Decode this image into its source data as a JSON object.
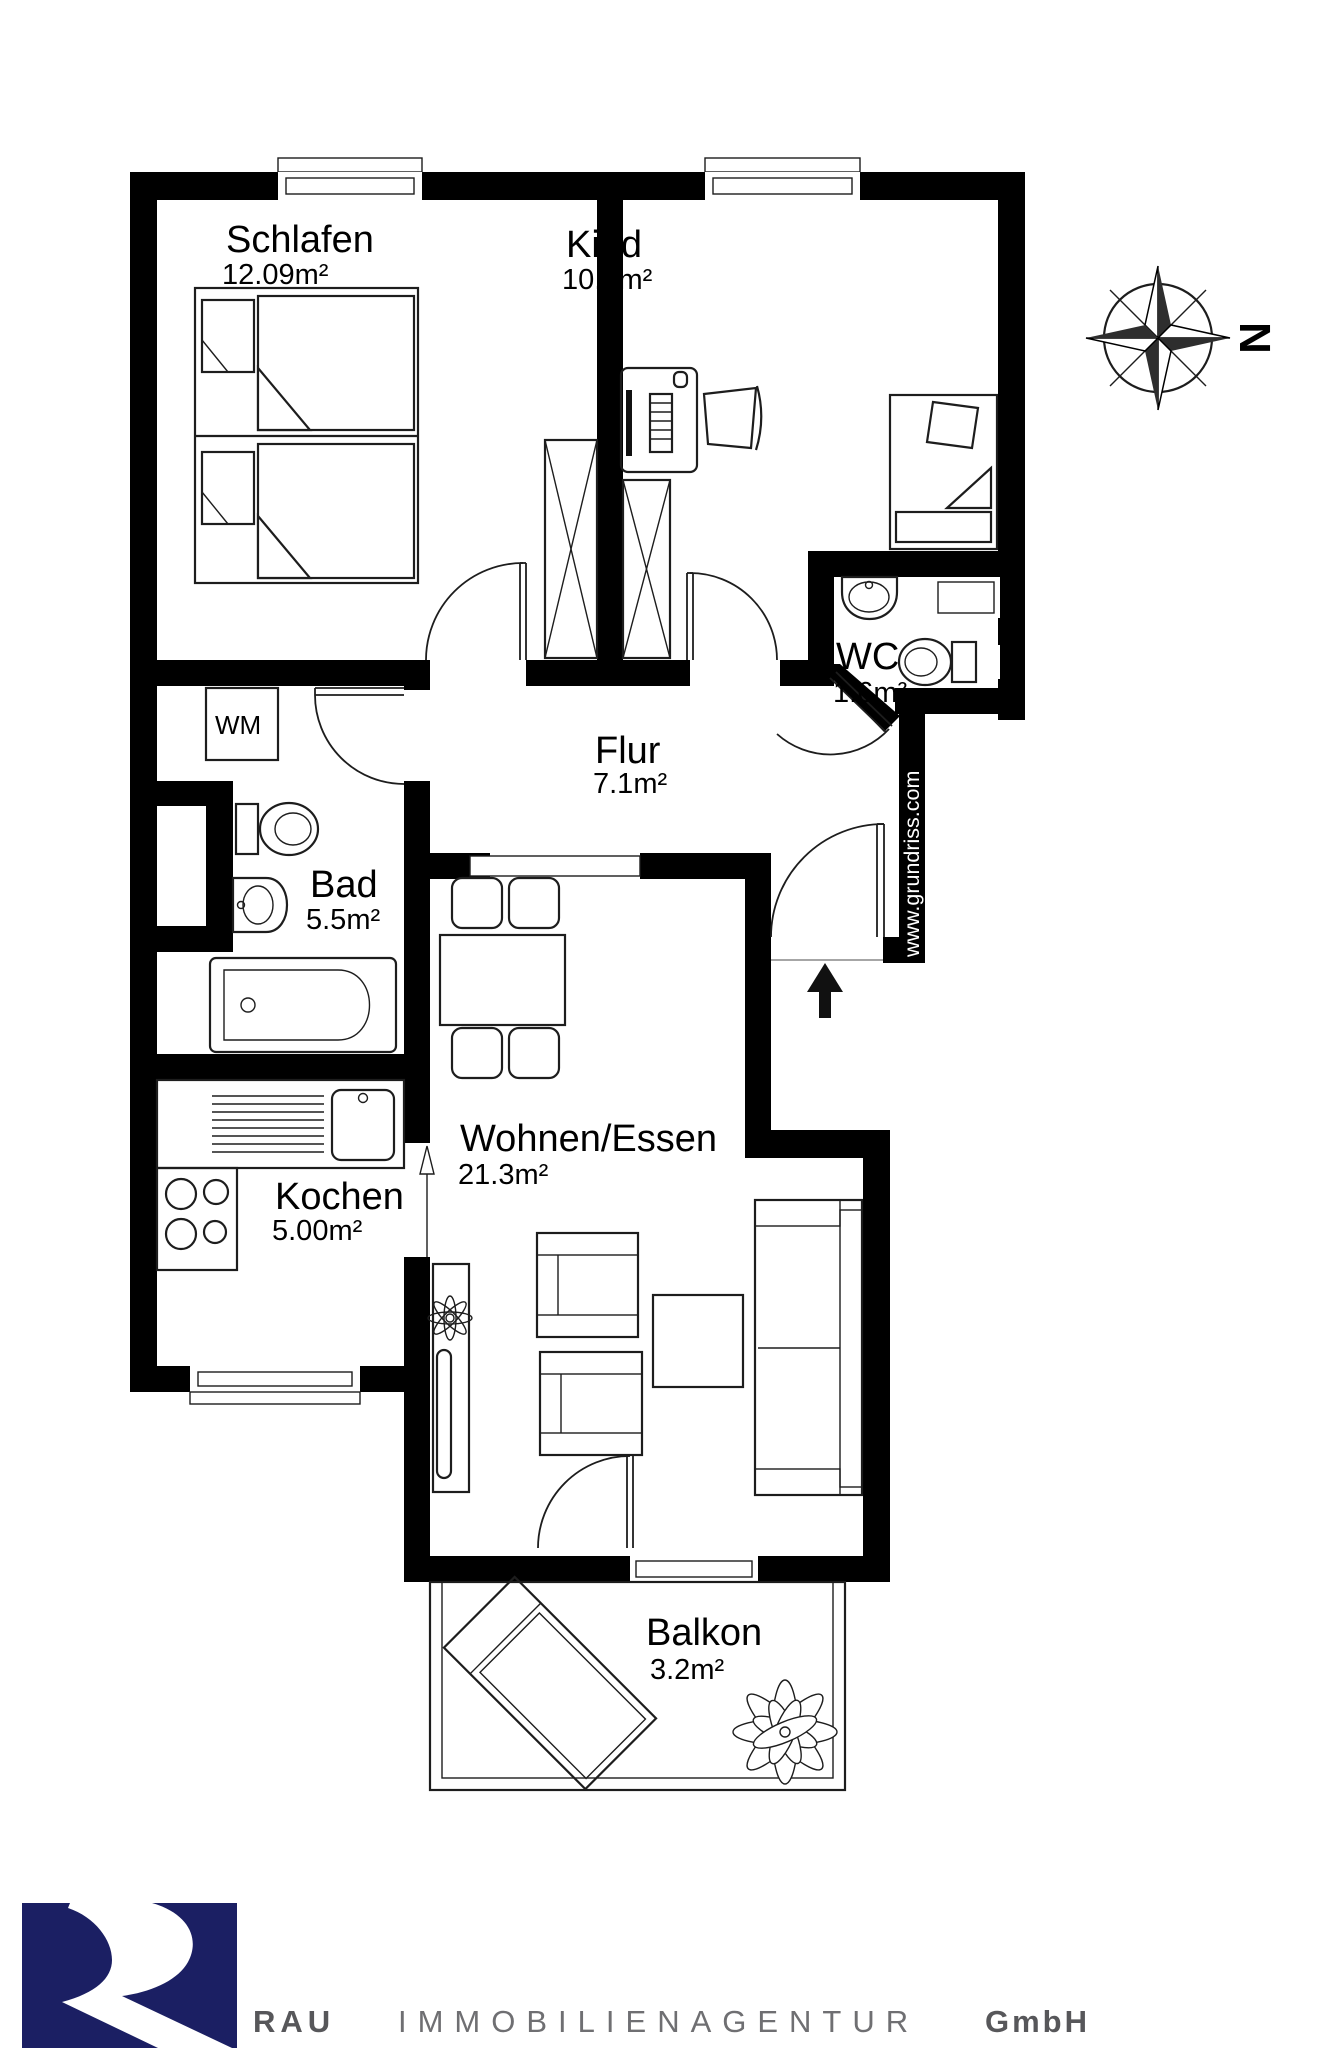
{
  "plan": {
    "rooms": {
      "schlafen": {
        "name": "Schlafen",
        "area": "12.09m²"
      },
      "kind": {
        "name": "Kind",
        "area": "10.8m²"
      },
      "wc": {
        "name": "WC",
        "area": "1.6m²"
      },
      "flur": {
        "name": "Flur",
        "area": "7.1m²"
      },
      "bad": {
        "name": "Bad",
        "area": "5.5m²"
      },
      "kochen": {
        "name": "Kochen",
        "area": "5.00m²"
      },
      "wohnen": {
        "name": "Wohnen/Essen",
        "area": "21.3m²"
      },
      "balkon": {
        "name": "Balkon",
        "area": "3.2m²"
      }
    },
    "labels": {
      "washing_machine": "WM"
    },
    "compass": {
      "letter": "N"
    },
    "watermark": {
      "text": "www.grundriss.com"
    },
    "colors": {
      "wall": "#000000",
      "furniture_line": "#1d1d1d"
    }
  },
  "footer": {
    "company_1": "RAU",
    "company_2": "IMMOBILIENAGENTUR",
    "company_3": "GmbH",
    "logo_color": "#1b1f63",
    "text_color": "#57575a"
  }
}
